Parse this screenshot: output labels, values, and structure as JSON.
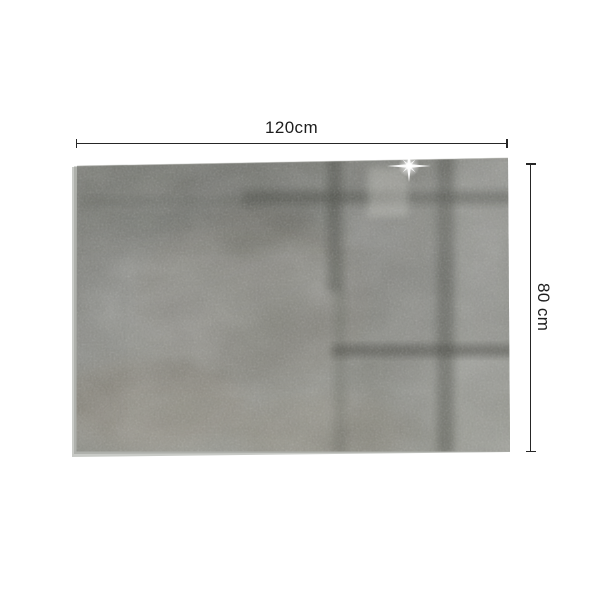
{
  "scene": {
    "background_color": "#ffffff",
    "subject": "glass panel with printed concrete texture",
    "annotation": {
      "width_label": "120cm",
      "height_label": "80 cm",
      "line_color": "#262626",
      "text_color": "#1d1d1d"
    },
    "product": {
      "base_color": "#8b8c86",
      "edge_color": "#c8cac6",
      "reflection_color": "#45473f",
      "glint": "sparkle-icon"
    }
  }
}
